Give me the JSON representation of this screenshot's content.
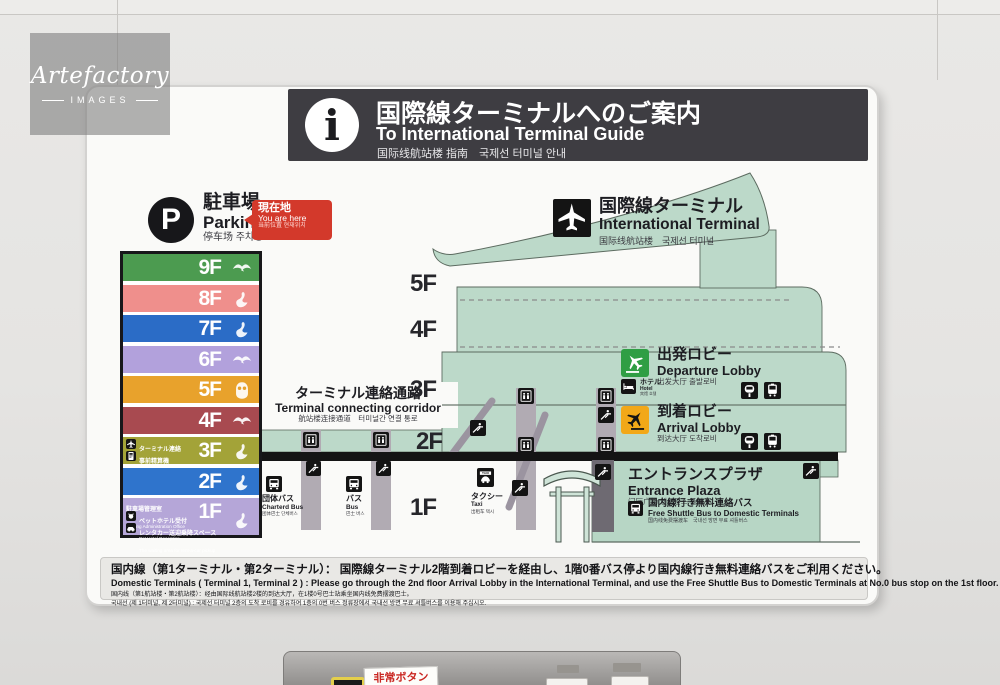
{
  "watermark": {
    "brand": "Artefactory",
    "tagline": "IMAGES"
  },
  "header": {
    "info_glyph": "i",
    "ja": "国際線ターミナルへのご案内",
    "en": "To International Terminal Guide",
    "sub": "国际线航站楼 指南　국제선 터미널 안내"
  },
  "parking": {
    "p_glyph": "P",
    "ja": "駐車場",
    "en": "Parking",
    "sub": "停车场 주차장",
    "here": {
      "ja": "現在地",
      "en": "You are here",
      "sub": "当前位置 현재위치",
      "color": "#d3392b"
    }
  },
  "tower": {
    "floors": [
      {
        "label": "9F",
        "color": "#4c9b50",
        "bird": "bird-flying"
      },
      {
        "label": "8F",
        "color": "#ef8f8c",
        "bird": "bird-standing"
      },
      {
        "label": "7F",
        "color": "#2b6cc6",
        "bird": "bird-standing"
      },
      {
        "label": "6F",
        "color": "#b2a1dc",
        "bird": "bird-flying"
      },
      {
        "label": "5F",
        "color": "#e8a22c",
        "bird": "bird-owl"
      },
      {
        "label": "4F",
        "color": "#a84a50",
        "bird": "bird-flying"
      },
      {
        "label": "3F",
        "color": "#a3a338",
        "bird": "bird-standing",
        "items": [
          {
            "ja": "ターミナル連絡",
            "en": "To Terminal"
          },
          {
            "ja": "事前精算機",
            "en": "Prepayment Terminal"
          }
        ]
      },
      {
        "label": "2F",
        "color": "#2f74cc",
        "bird": "bird-standing"
      },
      {
        "label": "1F",
        "color": "#b5a6d8",
        "bird": "bird-standing",
        "office": {
          "ja": "駐車場管理室",
          "en": "Parking Administration Office"
        },
        "items": [
          {
            "ja": "ペットホテル受付",
            "en": "Pet Hotel Reception"
          },
          {
            "ja": "レンタカー送迎乗降スペース",
            "en": "The waiting area for rent-a-car pickup"
          }
        ]
      }
    ]
  },
  "corridor": {
    "ja": "ターミナル連絡通路",
    "en": "Terminal connecting corridor",
    "sub": "航站楼连接通道　터미널간 연결 통로"
  },
  "terminal": {
    "ja": "国際線ターミナル",
    "en": "International Terminal",
    "sub": "国际线航站楼　국제선 터미널"
  },
  "floor_labels": [
    "5F",
    "4F",
    "3F",
    "2F",
    "1F"
  ],
  "facilities": {
    "departure": {
      "ja": "出発ロビー",
      "en": "Departure Lobby",
      "sub": "出发大厅 출발로비",
      "color": "#2f9e44"
    },
    "hotel": {
      "ja": "ホテル",
      "en": "Hotel",
      "sub": "宾馆 호텔"
    },
    "arrival": {
      "ja": "到着ロビー",
      "en": "Arrival Lobby",
      "sub": "到达大厅 도착로비",
      "color": "#f2a818"
    },
    "plaza": {
      "ja": "エントランスプラザ",
      "en": "Entrance Plaza",
      "sub": "门厅广场 엔트런스 플라자"
    },
    "shuttle": {
      "ja": "国内線行き無料連絡バス",
      "en": "Free Shuttle Bus to Domestic Terminals",
      "sub": "国内线免费摆渡车　국내선 방면 무료 셔틀버스"
    },
    "chartered_bus": {
      "ja": "団体バス",
      "en": "Charterd Bus",
      "sub": "团体巴士 단체버스"
    },
    "bus": {
      "ja": "バス",
      "en": "Bus",
      "sub": "巴士 버스"
    },
    "taxi": {
      "ja": "タクシー",
      "en": "Taxi",
      "sub": "出租车 택시"
    }
  },
  "footer": {
    "ja": "国内線（第1ターミナル・第2ターミナル）： 国際線ターミナル2階到着ロビーを経由し、1階0番バス停より国内線行き無料連絡バスをご利用ください。",
    "en": "Domestic Terminals ( Terminal 1, Terminal 2 ) : Please go through the 2nd floor Arrival Lobby in the International Terminal, and use the Free Shuttle Bus to Domestic Terminals at No.0 bus stop on the 1st floor.",
    "zh": "国内线（第1航站楼・第2航站楼）：经由国际线航站楼2楼的到达大厅，在1楼0号巴士站乘坐国内线免费摆渡巴士。",
    "ko": "국내선 (제 1터미널, 제 2터미널) : 국제선 터미널 2층의 도착 로비를 경유하여 1층의 0번 버스 정류장에서 국내선 방면 무료 셔틀버스를 이용해 주십시오."
  },
  "panel": {
    "emergency": "非常ボタン"
  },
  "colors": {
    "building": "#bcd9c9",
    "slab": "#141414",
    "header_bar": "#3e3d42",
    "shaft": "#b1abb3"
  }
}
